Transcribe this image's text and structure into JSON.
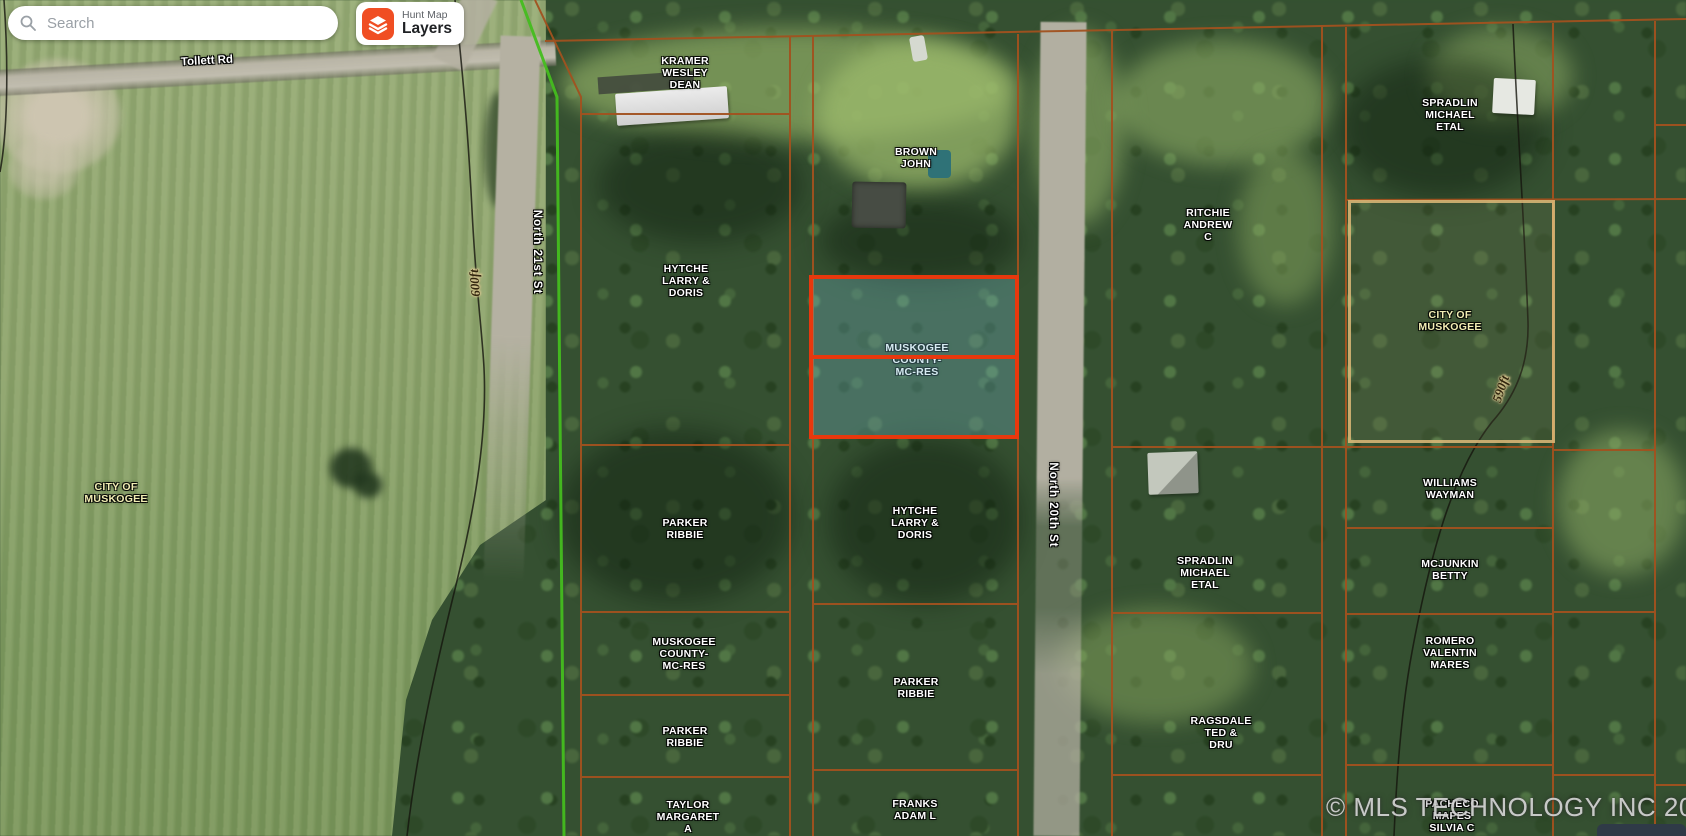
{
  "search": {
    "placeholder": "Search"
  },
  "layers_button": {
    "app_name": "Hunt Map",
    "label": "Layers"
  },
  "watermark": "© MLS TECHNOLOGY INC 2025",
  "roads": {
    "tollett": "Tollett Rd",
    "north_21st": "North 21st St",
    "north_20th": "North 20th St"
  },
  "contours": {
    "left": "600ft",
    "right": "590ft"
  },
  "colors": {
    "parcel_boundary": "#a2521f",
    "selected_parcel_border": "#e8380d",
    "selected_parcel_fill": "rgba(120,190,210,0.30)",
    "city_parcel_border": "#deba78",
    "city_limit_line": "#44bd1f",
    "owner_label": "#ffffff",
    "city_label": "#f2edb4",
    "layers_icon": "#f04e23"
  },
  "parcels": {
    "kramer": {
      "owner": "KRAMER\nWESLEY\nDEAN"
    },
    "hytche_west": {
      "owner": "HYTCHE\nLARRY &\nDORIS"
    },
    "parker_west_1": {
      "owner": "PARKER\nRIBBIE"
    },
    "muskogee_county_west": {
      "owner": "MUSKOGEE\nCOUNTY-\nMC-RES"
    },
    "parker_west_2": {
      "owner": "PARKER\nRIBBIE"
    },
    "taylor": {
      "owner": "TAYLOR\nMARGARET\nA"
    },
    "brown": {
      "owner": "BROWN\nJOHN"
    },
    "muskogee_county_selected": {
      "owner": "MUSKOGEE\nCOUNTY-\nMC-RES",
      "selected": true
    },
    "hytche_center": {
      "owner": "HYTCHE\nLARRY &\nDORIS"
    },
    "parker_center": {
      "owner": "PARKER\nRIBBIE"
    },
    "franks": {
      "owner": "FRANKS\nADAM L"
    },
    "ritchie": {
      "owner": "RITCHIE\nANDREW\nC"
    },
    "spradlin_center": {
      "owner": "SPRADLIN\nMICHAEL\nETAL"
    },
    "ragsdale": {
      "owner": "RAGSDALE\nTED &\nDRU"
    },
    "spradlin_ne": {
      "owner": "SPRADLIN\nMICHAEL\nETAL"
    },
    "city_of_muskogee_east": {
      "owner": "CITY OF\nMUSKOGEE"
    },
    "williams": {
      "owner": "WILLIAMS\nWAYMAN"
    },
    "mcjunkin": {
      "owner": "MCJUNKIN\nBETTY"
    },
    "romero": {
      "owner": "ROMERO\nVALENTIN\nMARES"
    },
    "pacheco": {
      "owner": "PACHECO\nMAPES\nSILVIA C"
    },
    "city_of_muskogee_west": {
      "owner": "CITY OF\nMUSKOGEE"
    }
  }
}
